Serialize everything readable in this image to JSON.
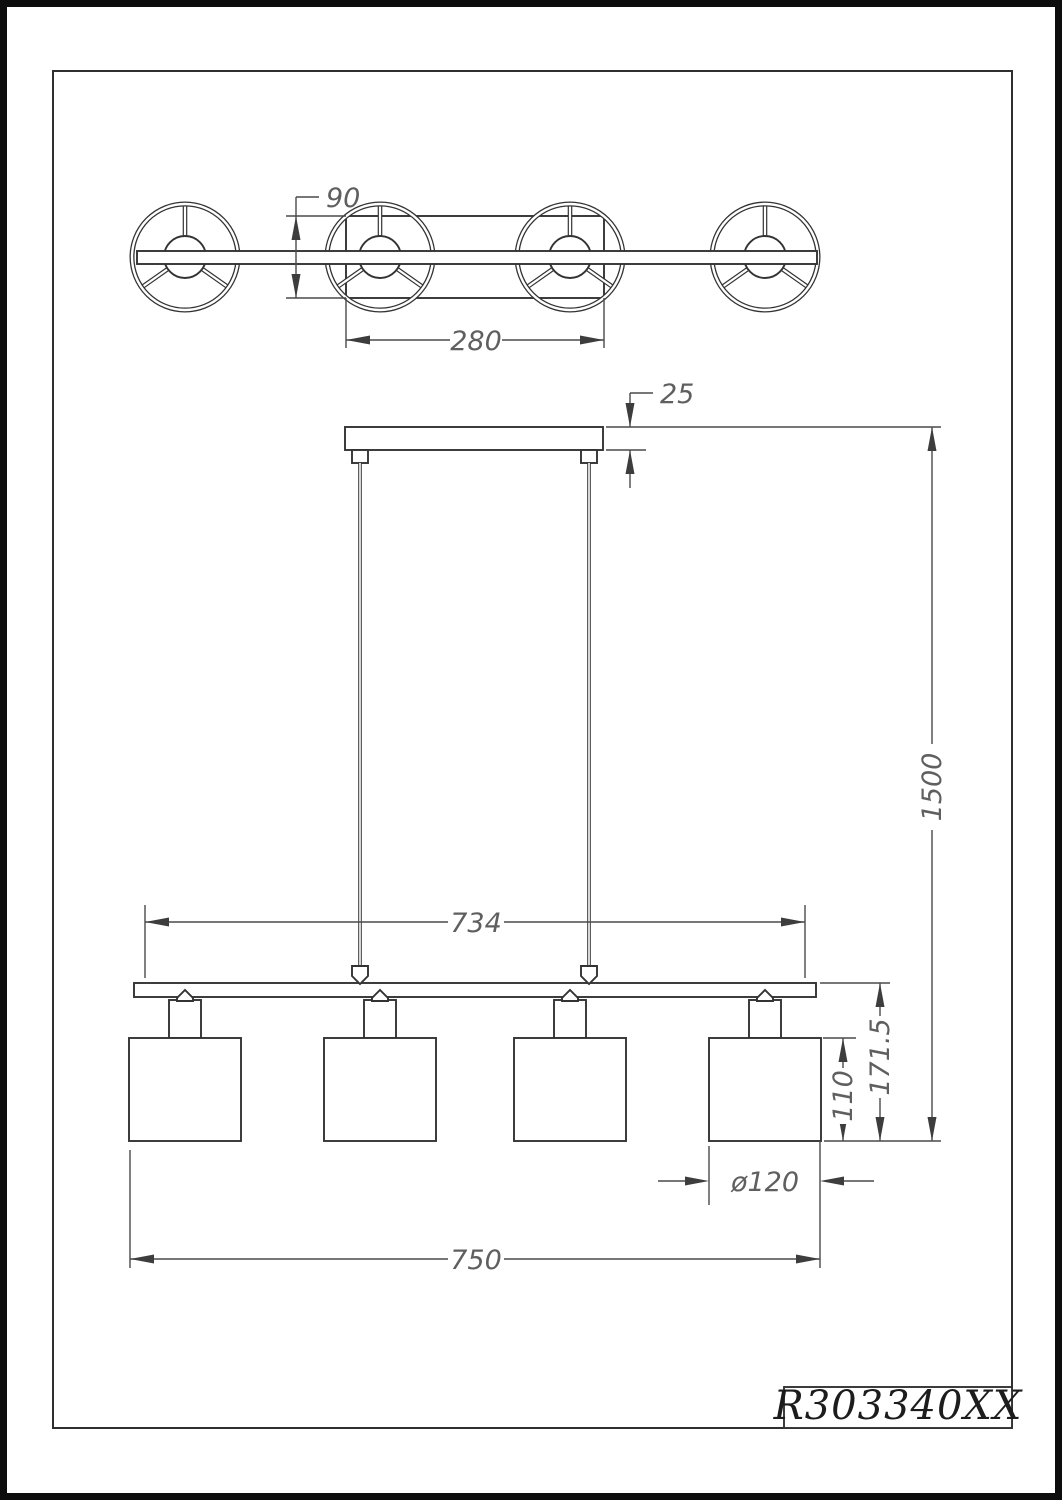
{
  "drawing": {
    "part_number": "R303340XX",
    "dimensions": {
      "canopy_depth": "90",
      "canopy_width": "280",
      "canopy_thickness": "25",
      "overall_drop": "1500",
      "suspension_span": "734",
      "fixture_body_height": "171.5",
      "shade_height": "110",
      "shade_diameter": "ø120",
      "overall_length": "750"
    },
    "colors": {
      "object_line": "#333333",
      "dimension_line": "#4a4a4a",
      "dimension_text": "#5f5f5f",
      "frame": "#2f2f2f",
      "outer_border": "#0d0d0d",
      "background": "#ffffff"
    }
  }
}
